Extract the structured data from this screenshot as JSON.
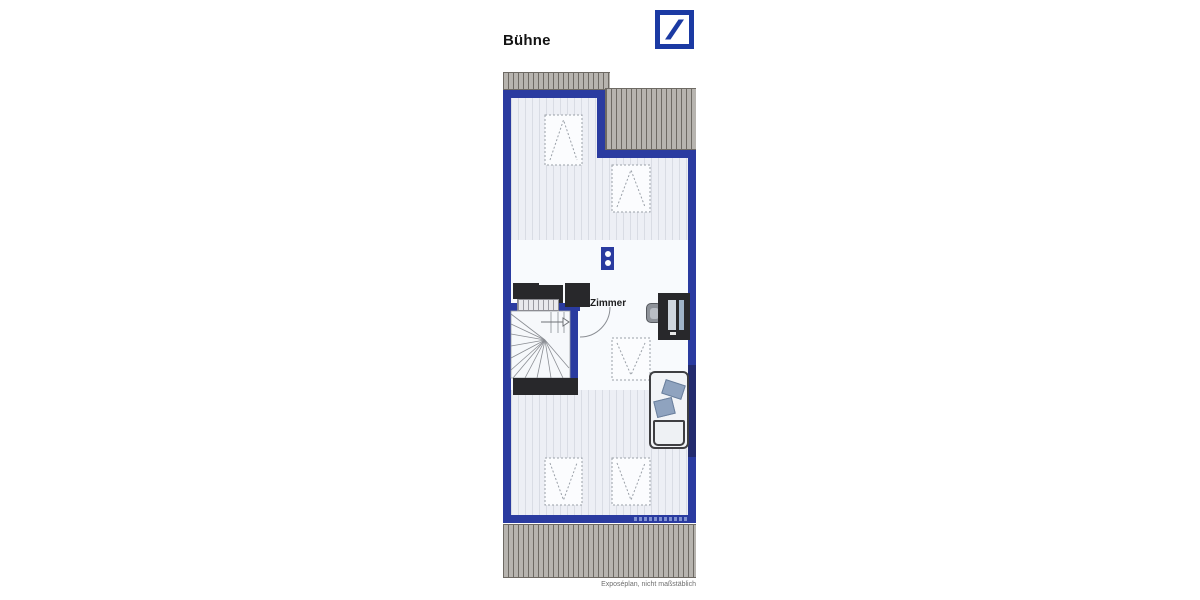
{
  "header": {
    "title": "Bühne"
  },
  "brand": {
    "logo": "deutsche-bank-logo",
    "color": "#1b3aa3"
  },
  "plan": {
    "room_label": "Zimmer",
    "footnote": "Exposéplan, nicht maßstäblich",
    "symbols": {
      "skylight_count": 5,
      "socket": "double-socket-symbol",
      "stairs": "winder-staircase-up",
      "door": "door-swing-quarter-arc"
    },
    "colors": {
      "wall": "#2a3ba0",
      "wall-dark": "#232b6e",
      "hatch-bar": "#b7b4af",
      "hatch-line": "#6e6a64",
      "floor": "#edeff5",
      "floor-line": "#d9dce4",
      "room": "#f8fafd",
      "furniture-dark": "#28282b",
      "pillow": "#8fa3bf"
    }
  }
}
